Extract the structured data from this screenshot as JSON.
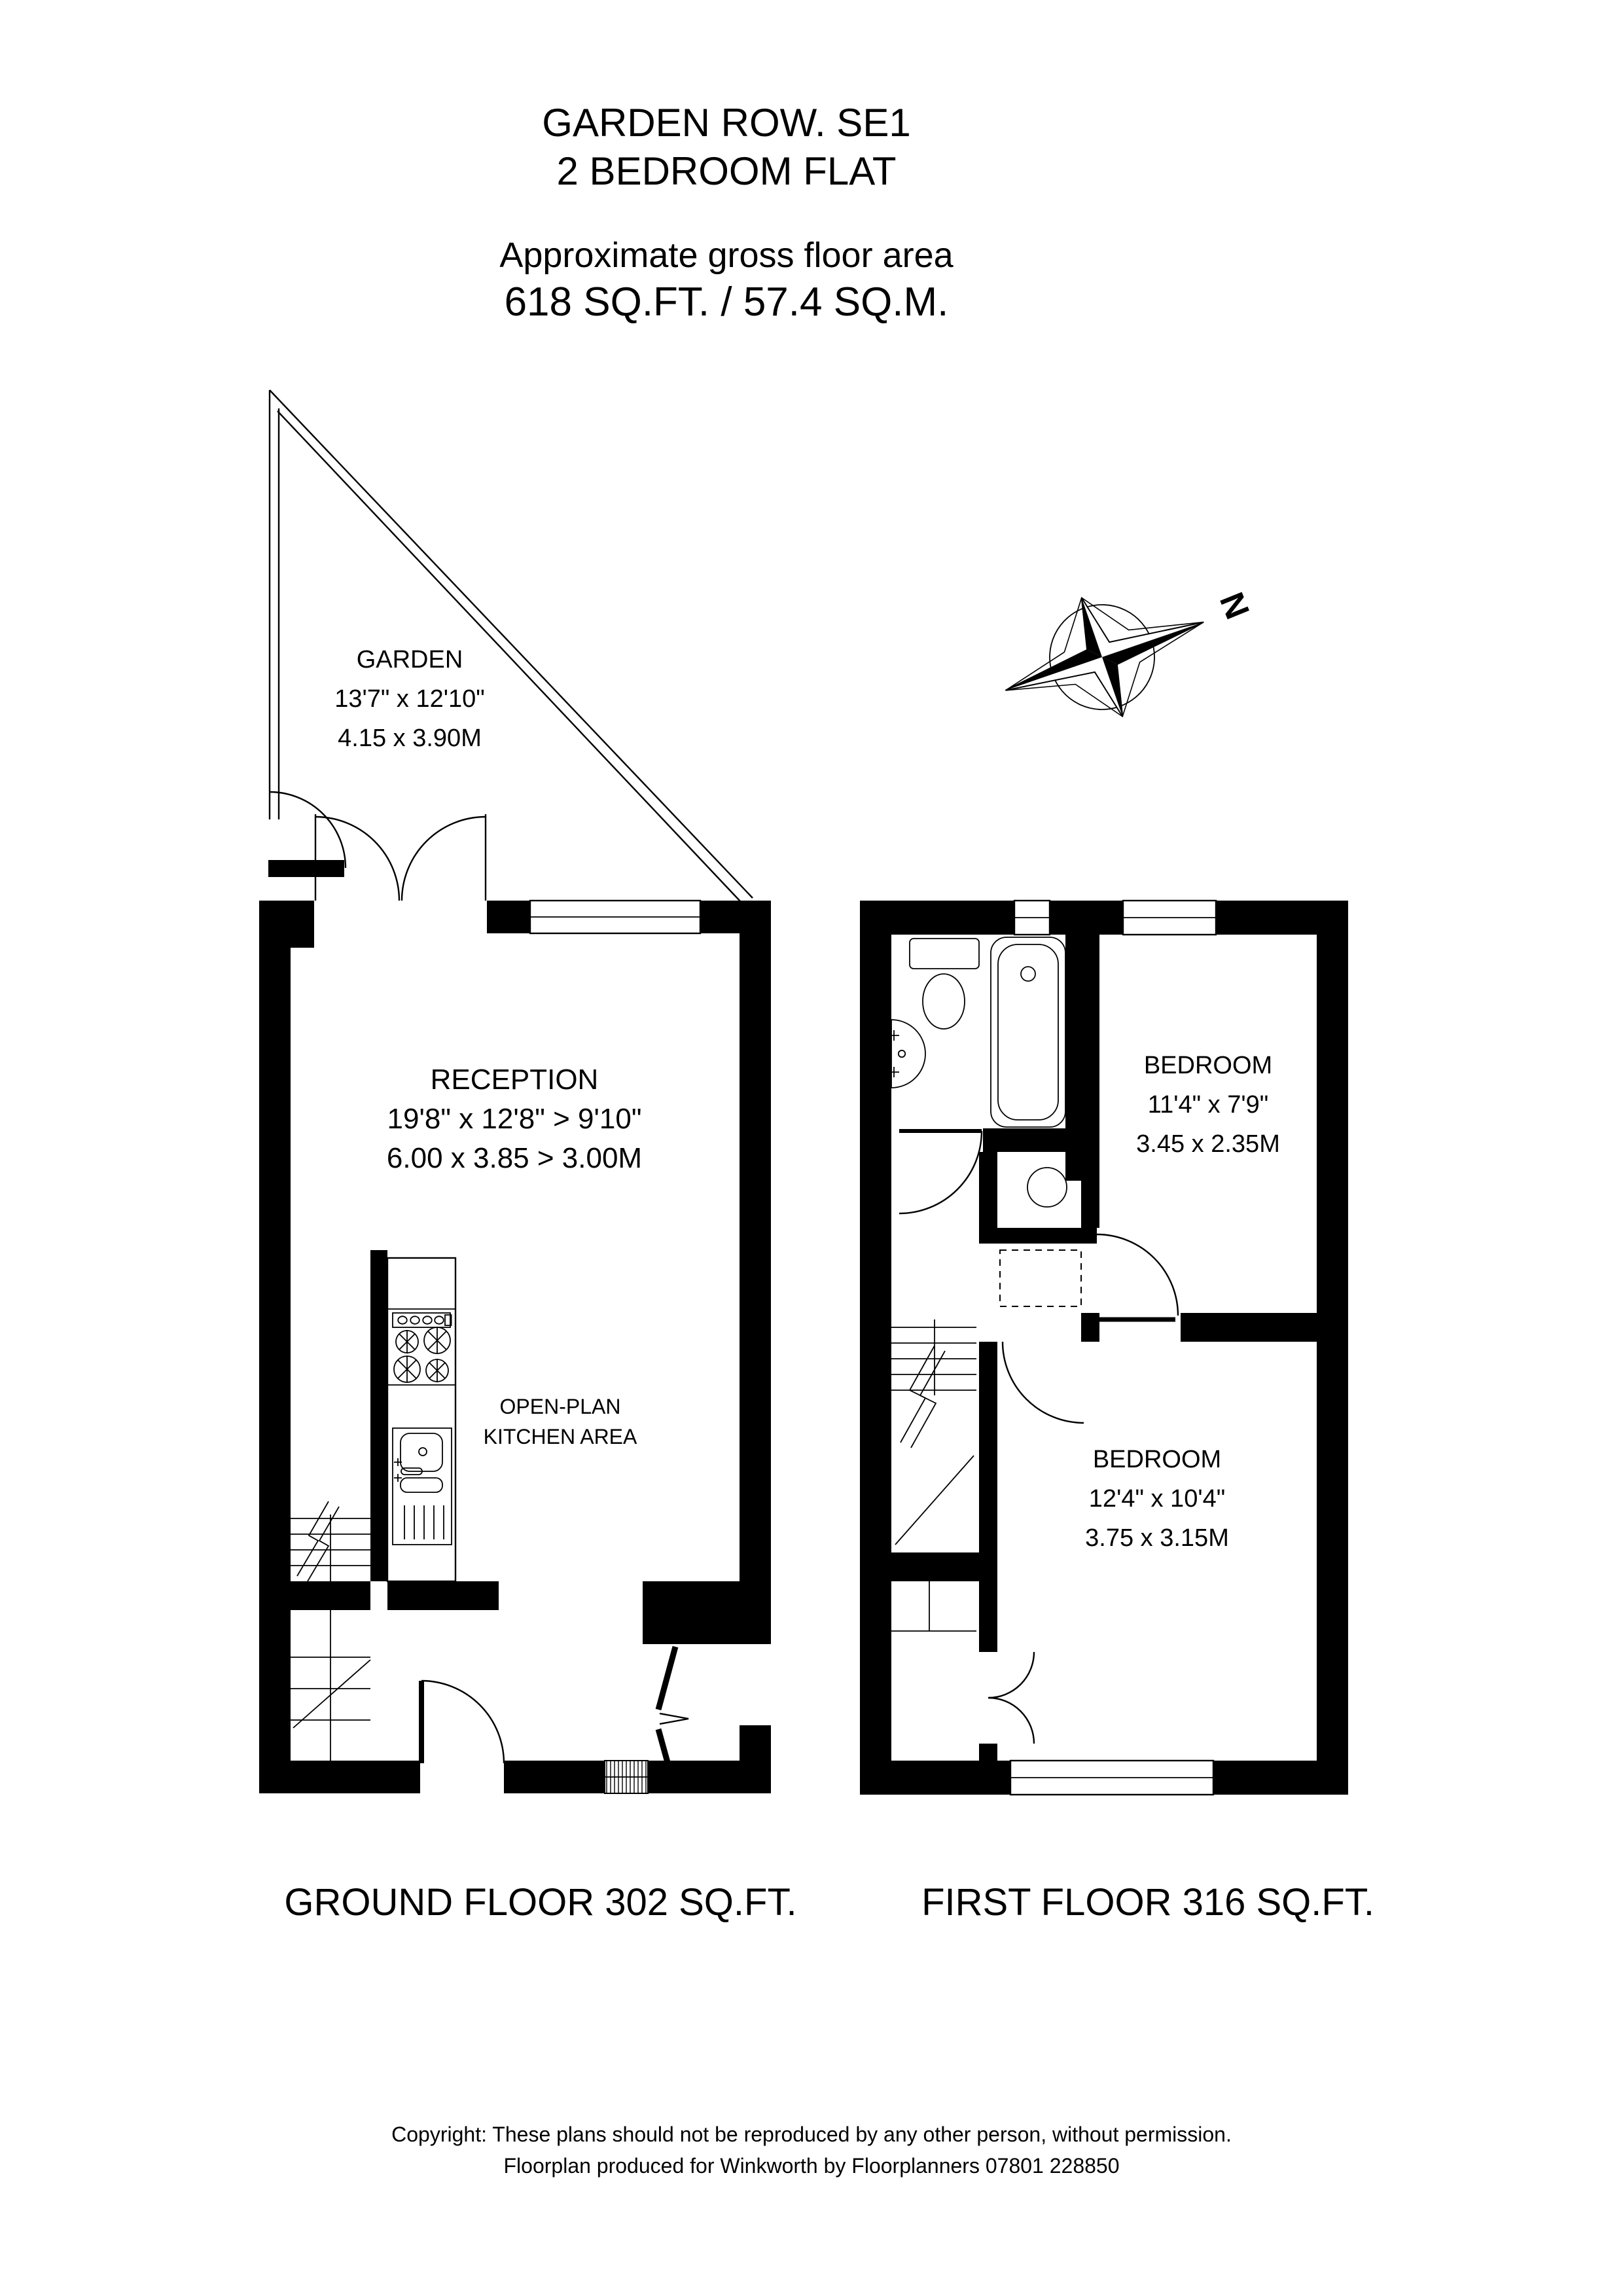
{
  "colors": {
    "ink": "#000000",
    "paper": "#ffffff"
  },
  "header": {
    "line1": "GARDEN ROW. SE1",
    "line2": "2 BEDROOM FLAT",
    "line3": "Approximate gross floor area",
    "line4": "618 SQ.FT. / 57.4 SQ.M."
  },
  "compass": {
    "label": "N"
  },
  "ground_floor": {
    "garden": {
      "name": "GARDEN",
      "dims_imperial": "13'7\" x 12'10\"",
      "dims_metric": "4.15 x 3.90M"
    },
    "reception": {
      "name": "RECEPTION",
      "dims_imperial": "19'8\" x 12'8\" > 9'10\"",
      "dims_metric": "6.00 x 3.85 > 3.00M"
    },
    "kitchen": {
      "line1": "OPEN-PLAN",
      "line2": "KITCHEN AREA"
    },
    "label": "GROUND FLOOR 302 SQ.FT."
  },
  "first_floor": {
    "bedroom1": {
      "name": "BEDROOM",
      "dims_imperial": "11'4\" x 7'9\"",
      "dims_metric": "3.45 x 2.35M"
    },
    "bedroom2": {
      "name": "BEDROOM",
      "dims_imperial": "12'4\" x 10'4\"",
      "dims_metric": "3.75 x 3.15M"
    },
    "label": "FIRST FLOOR 316 SQ.FT."
  },
  "footer": {
    "line1": "Copyright: These plans should not be reproduced by any other person, without permission.",
    "line2": "Floorplan produced for Winkworth by Floorplanners 07801 228850"
  }
}
